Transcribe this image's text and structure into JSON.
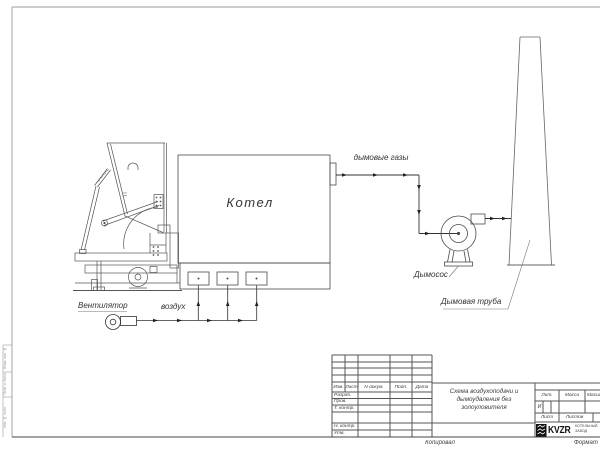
{
  "drawing": {
    "boiler_label": "Котел",
    "flue_gases_label": "дымовые газы",
    "exhauster_label": "Дымосос",
    "chimney_label": "Дымовая труба",
    "fan_label": "Вентилятор",
    "air_label": "воздух"
  },
  "side_stamp": {
    "cell1": "Взам. инв. №",
    "cell2": "Подп. и дата",
    "cell3": "Инв. № подл."
  },
  "title_block": {
    "header_cols": [
      "Изм.",
      "Лист",
      "N докум.",
      "Подп.",
      "Дата"
    ],
    "signature_rows": [
      "Разраб.",
      "Пров.",
      "Т. контр.",
      "Н. контр.",
      "Утв."
    ],
    "doc_title_lines": [
      "Схема воздухоподачи и",
      "дымоудаления без",
      "золоуловителя"
    ],
    "lit_label": "Лит.",
    "lit_value": "И",
    "mass_label": "Масса",
    "scale_label": "Масштаб",
    "sheet_label": "Лист",
    "sheets_label": "Листов",
    "logo_text": "KVZR",
    "company_line1": "КОТЕЛЬНЫЙ",
    "company_line2": "ЗАВОД",
    "copied_label": "Копировал",
    "format_label": "Формат"
  },
  "colors": {
    "line": "#4a4a4a",
    "logo_black": "#111111"
  }
}
